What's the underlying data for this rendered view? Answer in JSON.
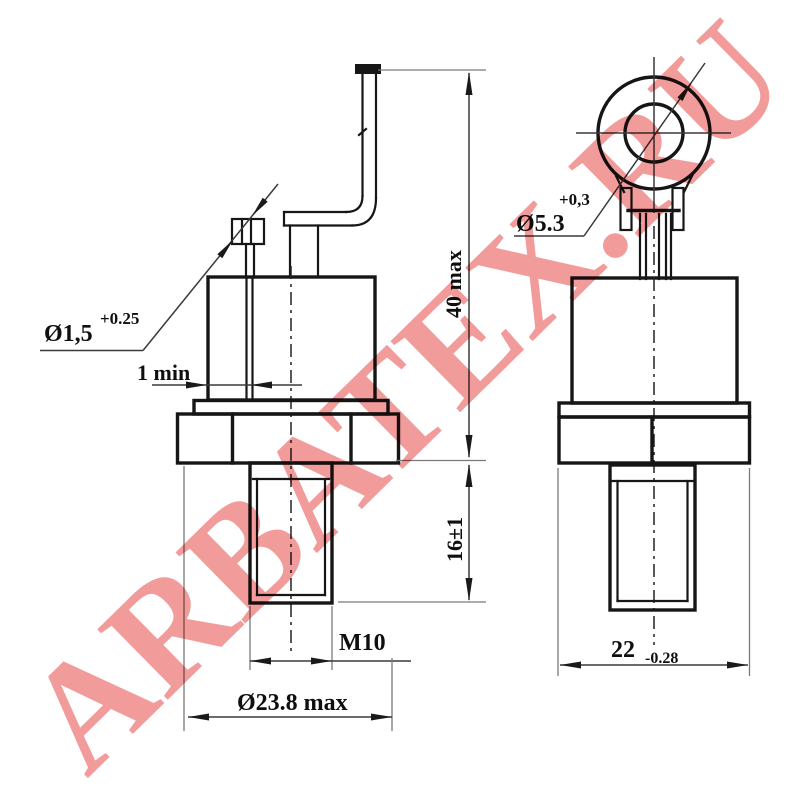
{
  "watermark": {
    "text": "ARBATEX.RU",
    "color": "#F29B9B"
  },
  "drawing": {
    "type": "technical-dimension-drawing",
    "component": "stud-mount semiconductor device, two side views",
    "line_color": "#161616",
    "labels": {
      "pin_diameter": {
        "base": "Ø1,5",
        "tolerance": "+0.25"
      },
      "gap_min": "1 min",
      "overall_height": "40 max",
      "stud_length": "16±1",
      "thread": "M10",
      "body_diameter": "Ø23.8 max",
      "lug_hole_diameter": {
        "base": "Ø5.3",
        "tolerance": "+0,3"
      },
      "hex_across_flats": {
        "base": "22",
        "tolerance": "-0.28"
      }
    }
  }
}
